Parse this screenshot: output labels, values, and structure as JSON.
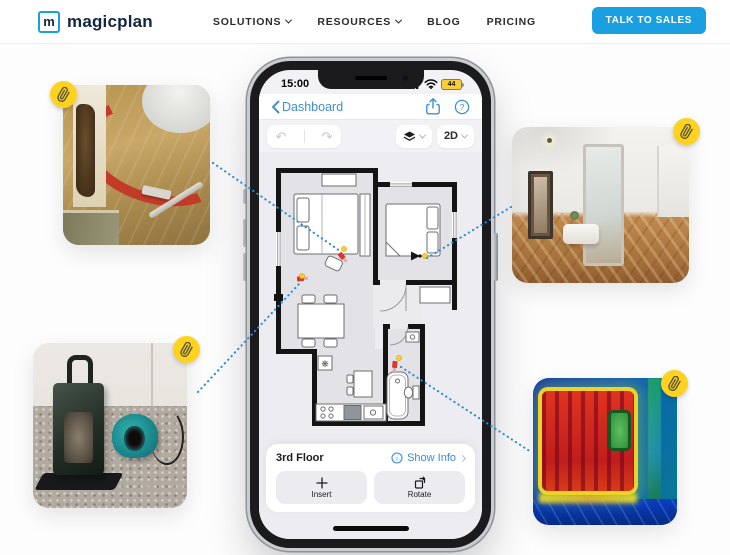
{
  "nav": {
    "logo_mark": "m",
    "logo_text": "magicplan",
    "items": [
      {
        "label": "SOLUTIONS",
        "dropdown": true
      },
      {
        "label": "RESOURCES",
        "dropdown": true
      },
      {
        "label": "BLOG",
        "dropdown": false
      },
      {
        "label": "PRICING",
        "dropdown": false
      }
    ],
    "cta_label": "TALK TO SALES"
  },
  "phone": {
    "status": {
      "time": "15:00",
      "battery_percent": "44"
    },
    "header": {
      "back_label": "Dashboard"
    },
    "toolbar": {
      "view_mode": "2D"
    },
    "floor_bar": {
      "floor_label": "3rd Floor",
      "show_info_label": "Show Info"
    },
    "actions": {
      "insert_label": "Insert",
      "rotate_label": "Rotate"
    }
  },
  "photos": [
    {
      "id": "water-damage-photo",
      "desc": "water damaged wall, red hose and bucket on subfloor"
    },
    {
      "id": "room-panorama-photo",
      "desc": "360 panorama of white room with wood floor and mirror"
    },
    {
      "id": "drying-equipment-photo",
      "desc": "dehumidifier and teal air mover on carpet"
    },
    {
      "id": "thermal-radiator-photo",
      "desc": "thermal infrared image of a hot radiator"
    }
  ],
  "icons": {
    "help_glyph": "?",
    "info_glyph": "i",
    "undo_glyph": "↶",
    "redo_glyph": "↷",
    "fan_glyph": "❋"
  },
  "colors": {
    "accent_blue": "#1a9fe0",
    "ios_link_blue": "#4090cf",
    "badge_yellow": "#ffd21f",
    "connector_blue": "#2d8dd6",
    "marker_red": "#d63b32"
  }
}
